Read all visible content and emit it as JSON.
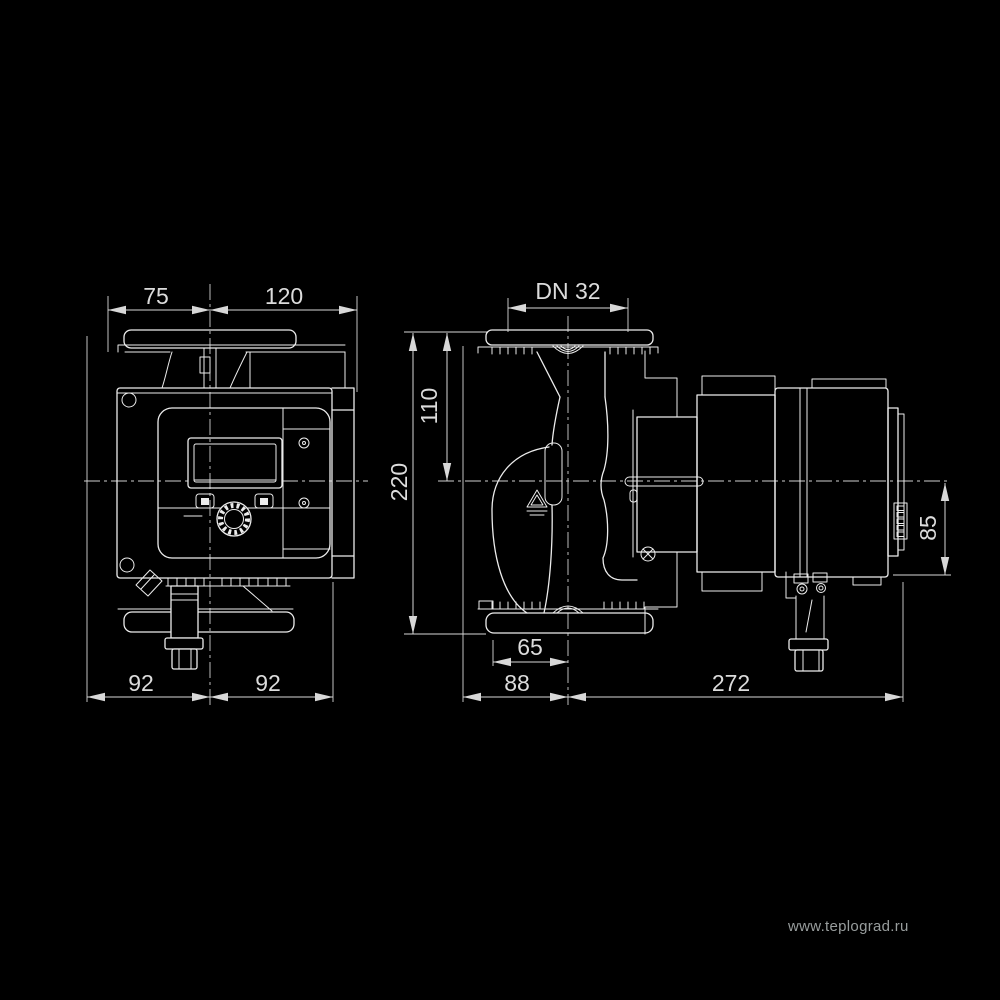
{
  "colors": {
    "background": "#000000",
    "line": "#ececec",
    "label": "#dcdcdc",
    "watermark": "#989d9d"
  },
  "views": {
    "front": {
      "dims": {
        "width_left": "75",
        "width_right": "120",
        "base_left": "92",
        "base_right": "92"
      }
    },
    "side": {
      "dims": {
        "nominal": "DN 32",
        "center_height": "110",
        "total_height": "220",
        "port_offset": "65",
        "length_left": "88",
        "length_right": "272",
        "module_height": "85"
      }
    }
  },
  "watermark": {
    "text": "www.teplograd.ru"
  }
}
